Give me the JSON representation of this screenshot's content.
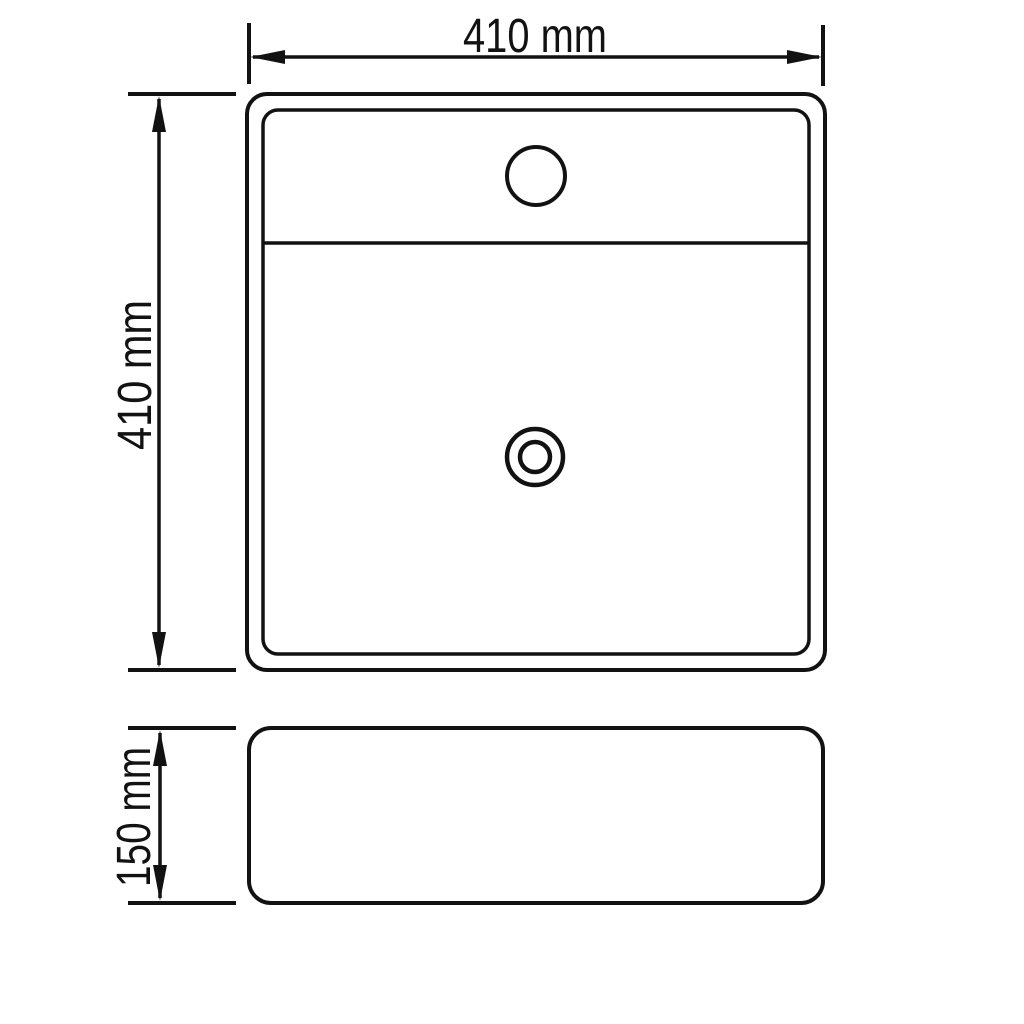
{
  "dimensions": {
    "top_width": "410 mm",
    "left_depth": "410 mm",
    "side_height": "150 mm"
  },
  "colors": {
    "line": "#121212",
    "background": "#ffffff"
  }
}
